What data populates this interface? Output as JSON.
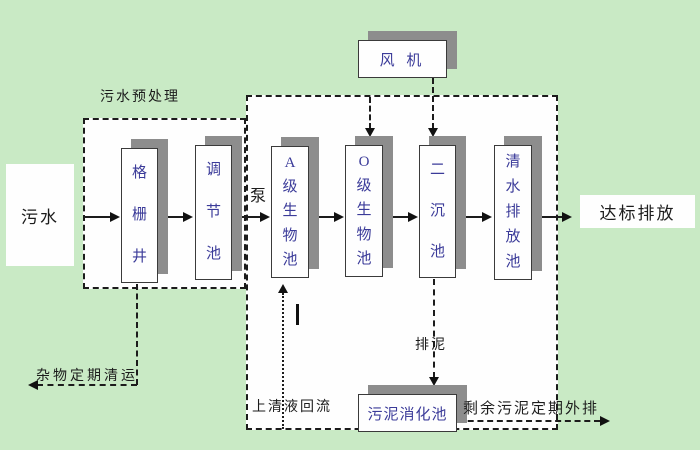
{
  "diagram": {
    "colors": {
      "background": "#c9eac5",
      "zone_fill": "#fefefe",
      "tank_text": "#3b3b99",
      "line": "#1c1c1c",
      "shadow": "#8d8d8d"
    },
    "source": {
      "label": "污水"
    },
    "output": {
      "label": "达标排放"
    },
    "pretreatment_zone": {
      "label": "污水预处理"
    },
    "pump": {
      "label": "泵"
    },
    "blower": {
      "label": "风 机"
    },
    "tanks": [
      {
        "id": "grid-well",
        "label": "格栅井"
      },
      {
        "id": "regulating-tank",
        "label": "调节池"
      },
      {
        "id": "a-bio-tank",
        "label": "A级生物池"
      },
      {
        "id": "o-bio-tank",
        "label": "O级生物池"
      },
      {
        "id": "secondary-sedimentation-tank",
        "label": "二沉池"
      },
      {
        "id": "clean-water-discharge-tank",
        "label": "清水排放池"
      }
    ],
    "digestion_tank": {
      "label": "污泥消化池"
    },
    "annotations": {
      "debris_removal": "杂物定期清运",
      "supernatant_return": "上清液回流",
      "sludge_discharge": "排泥",
      "excess_sludge_out": "剩余污泥定期外排"
    }
  }
}
